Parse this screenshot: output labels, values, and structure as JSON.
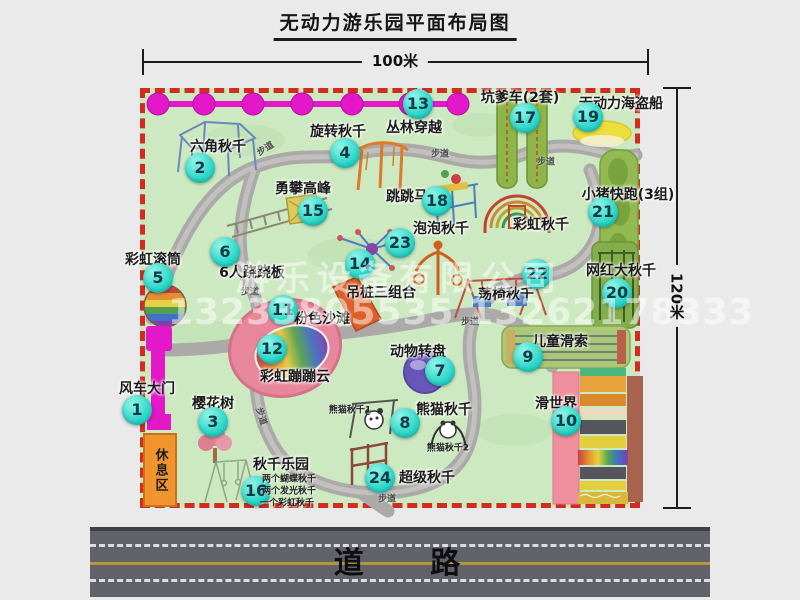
{
  "title": "无动力游乐园平面布局图",
  "dim_width": "100米",
  "dim_height": "120米",
  "road": {
    "label": "道 路"
  },
  "rest_area": "休息区",
  "walkway_text": "步道",
  "watermark": {
    "line1": "游乐设备有限公司",
    "line2": "13233805535 13262178333"
  },
  "colors": {
    "badge": "#2bd6c8",
    "border_red": "#d22c1e",
    "map_green": "#cde9c1",
    "magenta": "#e318c8",
    "road_gray": "#61616a",
    "rest_orange": "#f2952f"
  },
  "map_items": [
    {
      "num": 1,
      "name": "风车大门",
      "badge": {
        "x": 137,
        "y": 410
      },
      "label": {
        "x": 147,
        "y": 388
      }
    },
    {
      "num": 2,
      "name": "六角秋千",
      "badge": {
        "x": 200,
        "y": 168
      },
      "label": {
        "x": 218,
        "y": 146
      }
    },
    {
      "num": 3,
      "name": "樱花树",
      "badge": {
        "x": 213,
        "y": 422
      },
      "label": {
        "x": 213,
        "y": 403
      }
    },
    {
      "num": 4,
      "name": "旋转秋千",
      "badge": {
        "x": 345,
        "y": 153
      },
      "label": {
        "x": 338,
        "y": 131
      }
    },
    {
      "num": 5,
      "name": "彩虹滚筒",
      "badge": {
        "x": 158,
        "y": 278
      },
      "label": {
        "x": 153,
        "y": 259
      }
    },
    {
      "num": 6,
      "name": "6人跷跷板",
      "badge": {
        "x": 225,
        "y": 252
      },
      "label": {
        "x": 252,
        "y": 272
      }
    },
    {
      "num": 7,
      "name": "动物转盘",
      "badge": {
        "x": 440,
        "y": 371
      },
      "label": {
        "x": 418,
        "y": 351
      }
    },
    {
      "num": 8,
      "name": "熊猫秋千",
      "badge": {
        "x": 405,
        "y": 423
      },
      "label": {
        "x": 444,
        "y": 409
      }
    },
    {
      "num": 9,
      "name": "儿童滑索",
      "badge": {
        "x": 528,
        "y": 357
      },
      "label": {
        "x": 560,
        "y": 341
      }
    },
    {
      "num": 10,
      "name": "滑世界",
      "badge": {
        "x": 566,
        "y": 421
      },
      "label": {
        "x": 556,
        "y": 403
      }
    },
    {
      "num": 11,
      "name": "粉色沙滩",
      "badge": {
        "x": 283,
        "y": 310
      },
      "label": {
        "x": 322,
        "y": 318
      }
    },
    {
      "num": 12,
      "name": "彩虹蹦蹦云",
      "badge": {
        "x": 272,
        "y": 349
      },
      "label": {
        "x": 295,
        "y": 376
      }
    },
    {
      "num": 13,
      "name": "丛林穿越",
      "badge": {
        "x": 418,
        "y": 104
      },
      "label": {
        "x": 414,
        "y": 127
      }
    },
    {
      "num": 14,
      "name": "吊桩三组合",
      "badge": {
        "x": 360,
        "y": 264
      },
      "label": {
        "x": 381,
        "y": 292
      }
    },
    {
      "num": 15,
      "name": "勇攀高峰",
      "badge": {
        "x": 313,
        "y": 211
      },
      "label": {
        "x": 303,
        "y": 188
      }
    },
    {
      "num": 16,
      "name": "秋千乐园",
      "badge": {
        "x": 256,
        "y": 491
      },
      "label": {
        "x": 281,
        "y": 464
      }
    },
    {
      "num": 17,
      "name": "坑爹车(2套)",
      "badge": {
        "x": 525,
        "y": 118
      },
      "label": {
        "x": 520,
        "y": 97
      }
    },
    {
      "num": 18,
      "name": "跳跳马",
      "badge": {
        "x": 437,
        "y": 201
      },
      "label": {
        "x": 407,
        "y": 196
      }
    },
    {
      "num": 19,
      "name": "无动力海盗船",
      "badge": {
        "x": 588,
        "y": 117
      },
      "label": {
        "x": 621,
        "y": 103
      }
    },
    {
      "num": 20,
      "name": "网红大秋千",
      "badge": {
        "x": 617,
        "y": 293
      },
      "label": {
        "x": 621,
        "y": 270
      }
    },
    {
      "num": 21,
      "name": "小猪快跑(3组)",
      "badge": {
        "x": 603,
        "y": 212
      },
      "label": {
        "x": 628,
        "y": 194
      }
    },
    {
      "num": 22,
      "name": "荡椅秋千",
      "badge": {
        "x": 537,
        "y": 274
      },
      "label": {
        "x": 506,
        "y": 294
      }
    },
    {
      "num": 23,
      "name": "泡泡秋千",
      "badge": {
        "x": 400,
        "y": 243
      },
      "label": {
        "x": 441,
        "y": 228
      }
    },
    {
      "num": 24,
      "name": "超级秋千",
      "badge": {
        "x": 380,
        "y": 478
      },
      "label": {
        "x": 427,
        "y": 477
      }
    },
    {
      "num": null,
      "name": "彩虹秋千",
      "badge": null,
      "label": {
        "x": 541,
        "y": 224
      }
    }
  ],
  "sub_labels": [
    {
      "text": "熊猫秋千1",
      "x": 350,
      "y": 409,
      "fs": 9
    },
    {
      "text": "熊猫秋千2",
      "x": 448,
      "y": 447,
      "fs": 9
    },
    {
      "text": "两个蝴蝶秋千",
      "x": 289,
      "y": 478,
      "fs": 9
    },
    {
      "text": "两个发光秋千",
      "x": 289,
      "y": 490,
      "fs": 9
    },
    {
      "text": "一个彩虹秋千",
      "x": 287,
      "y": 502,
      "fs": 9
    }
  ],
  "walkway_labels": [
    {
      "x": 265,
      "y": 148,
      "r": -32
    },
    {
      "x": 440,
      "y": 153,
      "r": 0
    },
    {
      "x": 546,
      "y": 161,
      "r": 0
    },
    {
      "x": 250,
      "y": 291,
      "r": 0
    },
    {
      "x": 470,
      "y": 321,
      "r": 0
    },
    {
      "x": 262,
      "y": 416,
      "r": 72
    },
    {
      "x": 387,
      "y": 498,
      "r": 0
    }
  ]
}
